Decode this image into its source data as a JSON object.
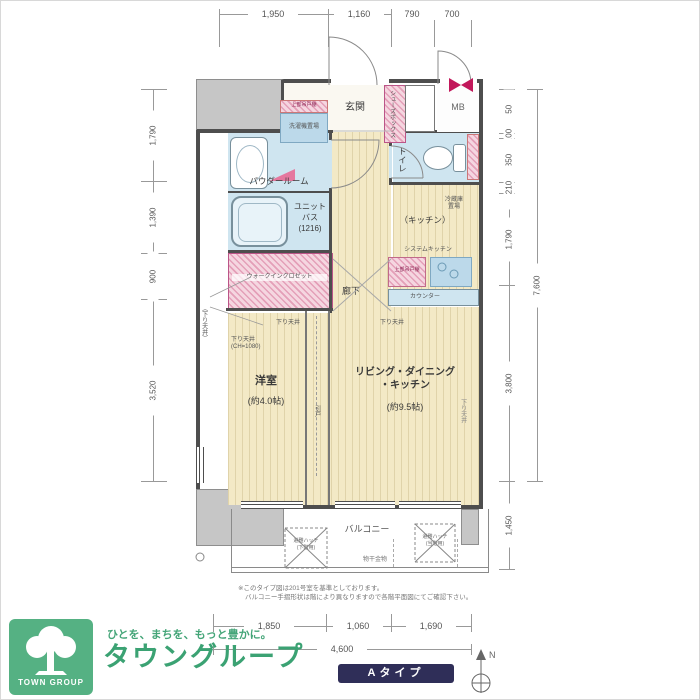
{
  "dims": {
    "top": [
      "1,950",
      "1,160",
      "790",
      "700"
    ],
    "bottom": [
      "1,850",
      "1,060",
      "1,690"
    ],
    "bottom_total": "4,600",
    "left": [
      "1,790",
      "1,390",
      "900",
      "3,520"
    ],
    "right": [
      "850",
      "100",
      "850",
      "210",
      "1,790",
      "3,800"
    ],
    "right_total": "7,600",
    "balcony_depth": "1,450"
  },
  "rooms": {
    "entrance": "玄関",
    "hallway": "廊下",
    "powder_room": "パウダールーム",
    "unit_bath_1": "ユニット",
    "unit_bath_2": "バス",
    "unit_bath_3": "(1216)",
    "toilet": "トイレ",
    "kitchen": "（キッチン）",
    "ldk_1": "リビング・ダイニング",
    "ldk_2": "・キッチン",
    "ldk_size": "(約9.5帖)",
    "western": "洋室",
    "western_size": "(約4.0帖)",
    "closet": "ウォークインクロゼット",
    "balcony": "バルコニー",
    "mb": "MB"
  },
  "fixtures": {
    "shoes_box": "シューズボックス",
    "washer": "洗濯機置場",
    "upper_cabinet": "上部吊戸棚",
    "fridge_1": "冷蔵庫",
    "fridge_2": "置場",
    "system_kitchen": "システムキッチン",
    "counter": "カウンター",
    "laundry_pole": "物干金物",
    "hatch": "避難ハッチ",
    "hatch_lower": "(下階用)",
    "hatch_this": "(当階用)",
    "lowered_ceiling": "下り天井",
    "lowered_ceiling_ch": "(CH=1080)",
    "lowered_ceiling_side": "（下り天井）",
    "sliding_door": "引戸"
  },
  "notes": {
    "line1": "※このタイプ図は201号室を基準としております。",
    "line2": "バルコニー手摺形状は階により異なりますので各階平面図にてご確認下さい。"
  },
  "footer": {
    "tagline": "ひとを、まちを、もっと豊かに。",
    "company": "タウングループ",
    "logo_text": "TOWN GROUP",
    "type_badge": "Aタイプ",
    "north": "N"
  },
  "colors": {
    "wall": "#4e4e4e",
    "floor_cream": "#f3e9c6",
    "wet_blue": "#cfe5f0",
    "storage_pink": "#e49fb8",
    "accent_green": "#3ba273",
    "badge_navy": "#2f2e58"
  }
}
